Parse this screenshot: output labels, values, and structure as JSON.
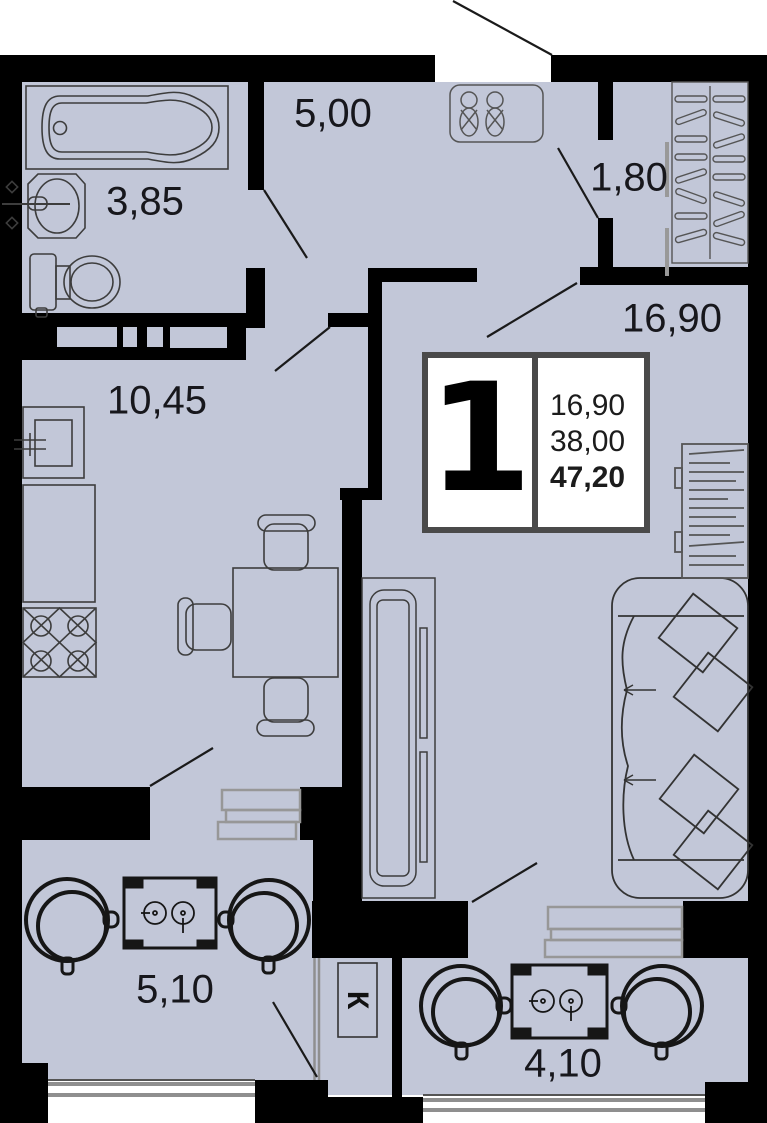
{
  "floor_plan": {
    "unit_card": {
      "rooms_count": "1",
      "living_area": "16,90",
      "apartment_area": "38,00",
      "total_area": "47,20"
    },
    "room_labels": {
      "hallway": "5,00",
      "wardrobe_nook": "1,80",
      "bathroom": "3,85",
      "living_room": "16,90",
      "kitchen": "10,45",
      "balcony_left": "5,10",
      "balcony_right": "4,10"
    },
    "duct_label": "К",
    "colors": {
      "floor": "#c2c7d8",
      "wall": "#000000",
      "furniture_outline": "#3d3d3d",
      "balcony_furniture": "#161616",
      "window_gray": "#8f8f8f",
      "card_border": "#4a4a4a"
    }
  }
}
